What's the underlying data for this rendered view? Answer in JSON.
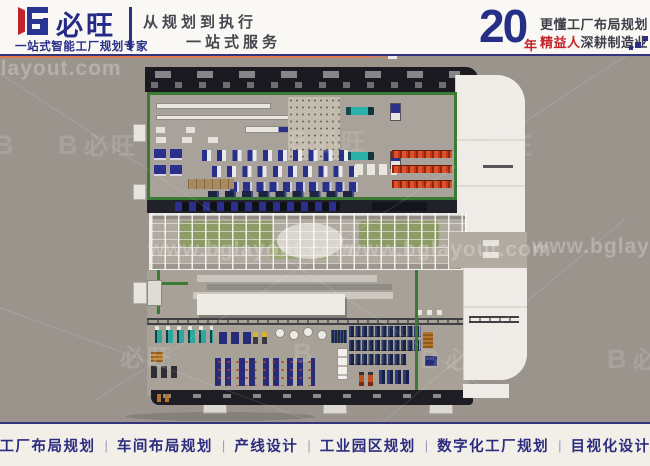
{
  "header": {
    "brand": {
      "name": "必旺",
      "tagline": "一站式智能工厂规划专家"
    },
    "slogan": {
      "line1": "从规划到执行",
      "line2": "一站式服务"
    },
    "years": {
      "number": "20",
      "unit": "年",
      "line1": "更懂工厂布局规划",
      "line2_highlight": "精益人",
      "line2_rest": "深耕制造业"
    }
  },
  "watermarks": {
    "url": "www.bglayout.com",
    "logo_glyph": "B",
    "logo_text": "必旺"
  },
  "palette": {
    "brand_navy": "#272e86",
    "brand_red": "#c4232b",
    "canvas_gray": "#9a948d",
    "roof_black": "#1a1a20",
    "wall_green": "#3a7a35",
    "floor_tan": "#a8a29a",
    "rack_orange": "#e0502a",
    "machine_teal": "#2aa8a0",
    "equipment_navy": "#262c77",
    "building_white": "#efece7",
    "footer_cream": "#f2efe9"
  },
  "footer": {
    "separator": "|",
    "items": [
      "工厂布局规划",
      "车间布局规划",
      "产线设计",
      "工业园区规划",
      "数字化工厂规划",
      "目视化设计"
    ]
  }
}
